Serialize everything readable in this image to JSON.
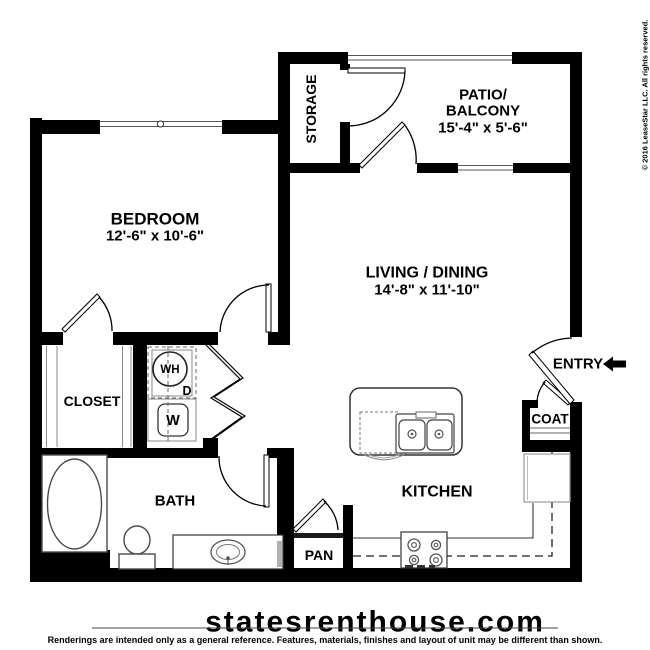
{
  "rooms": {
    "bedroom": {
      "name": "BEDROOM",
      "dims": "12'-6\" x 10'-6\""
    },
    "storage": {
      "name": "STORAGE"
    },
    "patio": {
      "line1": "PATIO/",
      "line2": "BALCONY",
      "dims": "15'-4\" x 5'-6\""
    },
    "living": {
      "name": "LIVING / DINING",
      "dims": "14'-8\" x 11'-10\""
    },
    "closet": {
      "name": "CLOSET"
    },
    "bath": {
      "name": "BATH"
    },
    "kitchen": {
      "name": "KITCHEN"
    },
    "pantry": {
      "name": "PAN"
    },
    "coat": {
      "name": "COAT"
    },
    "entry": {
      "name": "ENTRY"
    }
  },
  "appliances": {
    "water_heater": "WH",
    "dryer": "D",
    "washer": "W"
  },
  "watermark": "statesrenthouse.com",
  "copyright": "© 2016 LeaseStar LLC. All rights reserved.",
  "disclaimer": "Renderings are intended only as a general reference. Features, materials, finishes and layout of unit may be different than shown.",
  "colors": {
    "wall": "#000000",
    "background": "#ffffff",
    "watermark": "#e3e3e3",
    "copyright": "#9a9a9a"
  }
}
